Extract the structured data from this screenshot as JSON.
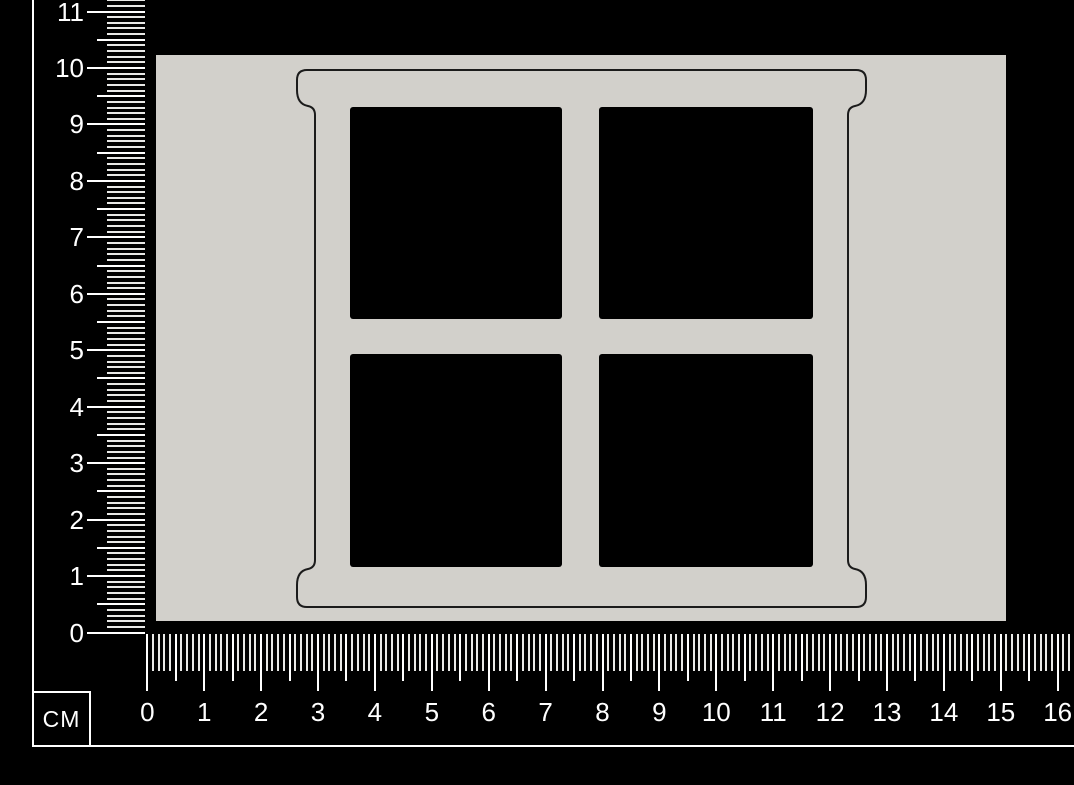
{
  "image": {
    "description": "Chipboard four-pane window frame craft piece on a grey backdrop card, photographed on black with centimetre rulers along the left and bottom edges",
    "kind": "product-measurement-photo"
  },
  "colors": {
    "background": "#000000",
    "backdrop": "#d2d0cb",
    "piece_fill": "#d2d0cb",
    "cut_line": "#1b1b1b",
    "pane": "#000000",
    "tick": "#ffffff",
    "tick_minor": "#e9e9e7",
    "text": "#ffffff"
  },
  "piece": {
    "name": "four-pane-window-frame",
    "pane_count": 4,
    "pane_rows": 2,
    "pane_cols": 2
  },
  "rulers": {
    "unit_label": "CM",
    "vertical": {
      "labels": [
        0,
        1,
        2,
        3,
        4,
        5,
        6,
        7,
        8,
        9,
        10,
        11
      ],
      "min": 0,
      "max": 11
    },
    "horizontal": {
      "labels": [
        0,
        1,
        2,
        3,
        4,
        5,
        6,
        7,
        8,
        9,
        10,
        11,
        12,
        13,
        14,
        15,
        16
      ],
      "min": 0,
      "max": 16
    }
  }
}
